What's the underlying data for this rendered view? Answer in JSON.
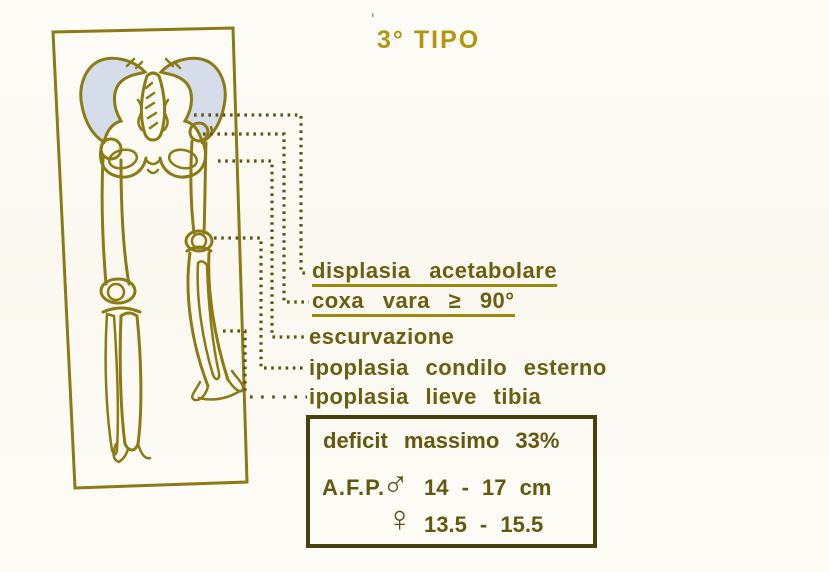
{
  "title": {
    "text": "3° TIPO",
    "stray_mark": "'"
  },
  "annotations": {
    "labels": [
      {
        "text": "displasia acetabolare",
        "underlined": true
      },
      {
        "text": "coxa vara ≥ 90°",
        "underlined": true
      },
      {
        "text": "escurvazione",
        "underlined": false
      },
      {
        "text": "ipoplasia condilo esterno",
        "underlined": false
      },
      {
        "text": "ipoplasia lieve tibia",
        "underlined": false
      }
    ]
  },
  "info_box": {
    "deficit_line": "deficit massimo 33%",
    "afp_label": "A.F.P.",
    "male": {
      "symbol": "♂",
      "range": "14 - 17 cm"
    },
    "female": {
      "symbol": "♀",
      "range": "13.5 - 15.5"
    }
  },
  "colors": {
    "background": "#fbf9f1",
    "bone_outline": "#8c7a14",
    "label_text": "#6b5e10",
    "underline": "#9e880c",
    "title_text": "#b2940d",
    "leader_dots": "#5e5310",
    "box_border": "#4a400e",
    "iliac_shading": "#d5ddeb"
  }
}
